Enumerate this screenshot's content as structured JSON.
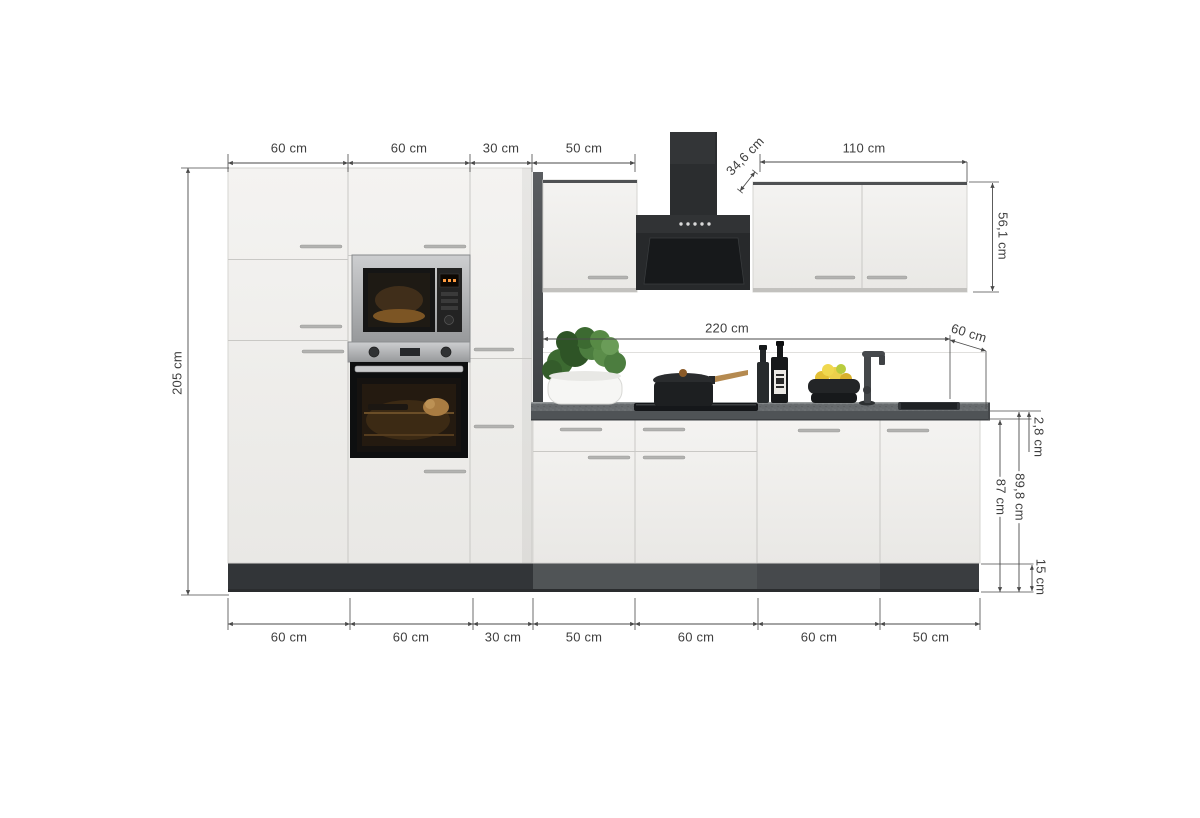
{
  "dimensions": {
    "top_widths": [
      "60 cm",
      "60 cm",
      "30 cm",
      "50 cm"
    ],
    "hood_depth": "34,6 cm",
    "upper_cabinet_width": "110 cm",
    "upper_cabinet_height": "56,1 cm",
    "total_height": "205 cm",
    "worktop_length": "220 cm",
    "worktop_depth": "60 cm",
    "worktop_thickness": "2,8 cm",
    "base_unit_height": "87 cm",
    "base_unit_height_incl_worktop": "89,8 cm",
    "plinth_height": "15 cm",
    "bottom_widths": [
      "60 cm",
      "60 cm",
      "30 cm",
      "50 cm",
      "60 cm",
      "60 cm",
      "50 cm"
    ]
  },
  "colors": {
    "background": "#ffffff",
    "cabinet_front": "#f1f0ee",
    "worktop": "#63676a",
    "appliance_black": "#26282a",
    "plinth": "#3c3f42",
    "dimension_lines": "#4a4a4a"
  }
}
